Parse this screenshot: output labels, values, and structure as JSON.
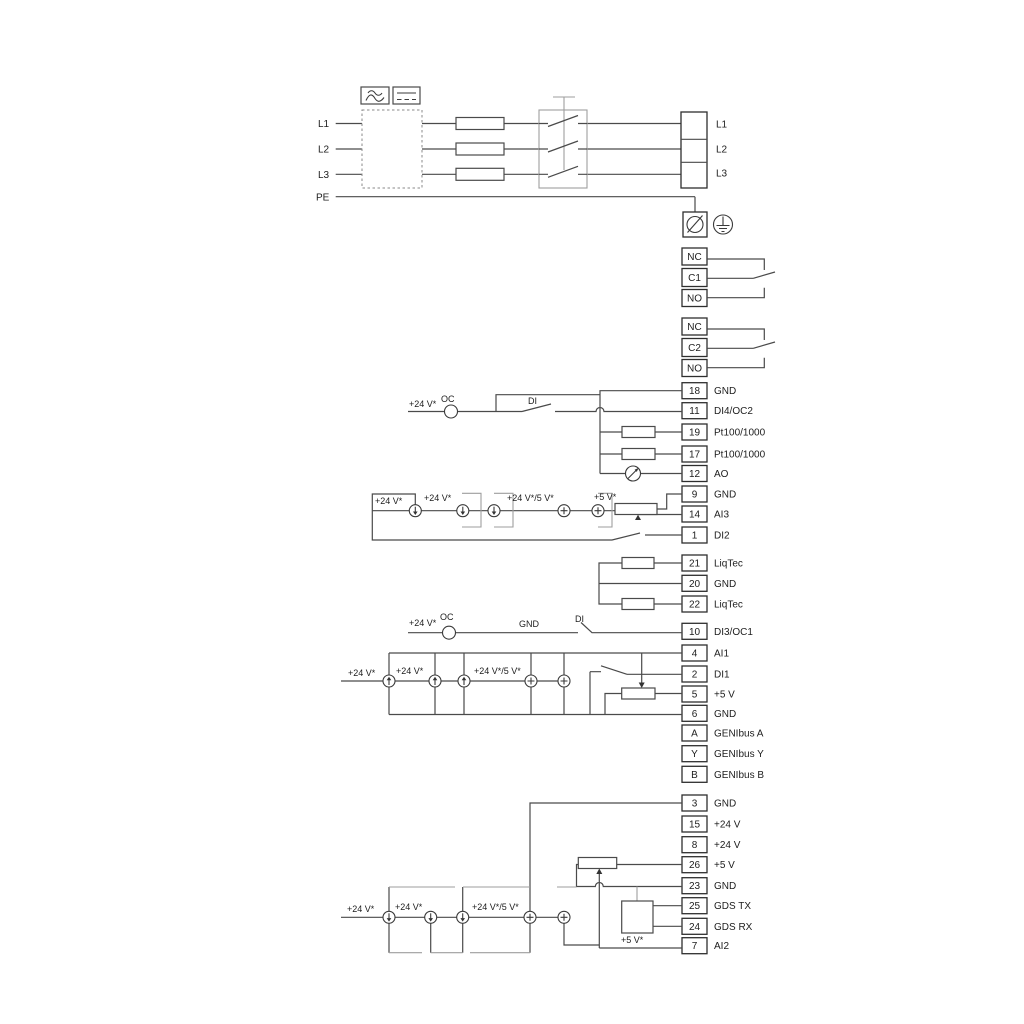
{
  "power": {
    "left": [
      "L1",
      "L2",
      "L3",
      "PE"
    ],
    "right": [
      "L1",
      "L2",
      "L3"
    ]
  },
  "relay1": {
    "rows": [
      "NC",
      "C1",
      "NO"
    ]
  },
  "relay2": {
    "rows": [
      "NC",
      "C2",
      "NO"
    ]
  },
  "io1": {
    "rows": [
      {
        "num": "18",
        "label": "GND"
      },
      {
        "num": "11",
        "label": "DI4/OC2"
      },
      {
        "num": "19",
        "label": "Pt100/1000"
      },
      {
        "num": "17",
        "label": "Pt100/1000"
      },
      {
        "num": "12",
        "label": "AO"
      },
      {
        "num": "9",
        "label": "GND"
      },
      {
        "num": "14",
        "label": "AI3"
      },
      {
        "num": "1",
        "label": "DI2"
      }
    ]
  },
  "liqtec": {
    "rows": [
      {
        "num": "21",
        "label": "LiqTec"
      },
      {
        "num": "20",
        "label": "GND"
      },
      {
        "num": "22",
        "label": "LiqTec"
      }
    ]
  },
  "io2": {
    "rows": [
      {
        "num": "10",
        "label": "DI3/OC1"
      },
      {
        "num": "4",
        "label": "AI1"
      },
      {
        "num": "2",
        "label": "DI1"
      },
      {
        "num": "5",
        "label": "+5 V"
      },
      {
        "num": "6",
        "label": "GND"
      },
      {
        "num": "A",
        "label": "GENIbus A"
      },
      {
        "num": "Y",
        "label": "GENIbus Y"
      },
      {
        "num": "B",
        "label": "GENIbus B"
      }
    ]
  },
  "io3": {
    "rows": [
      {
        "num": "3",
        "label": "GND"
      },
      {
        "num": "15",
        "label": "+24 V"
      },
      {
        "num": "8",
        "label": "+24 V"
      },
      {
        "num": "26",
        "label": "+5 V"
      },
      {
        "num": "23",
        "label": "GND"
      },
      {
        "num": "25",
        "label": "GDS TX"
      },
      {
        "num": "24",
        "label": "GDS RX"
      },
      {
        "num": "7",
        "label": "AI2"
      }
    ]
  },
  "ann": {
    "v24": "+24 V*",
    "v24_5": "+24 V*/5 V*",
    "v5": "+5 V*",
    "oc": "OC",
    "di": "DI",
    "gnd": "GND"
  },
  "colors": {
    "wire": "#4a4a4a",
    "wire_light": "#9e9e9e",
    "text": "#1d1d1d",
    "background": "#ffffff"
  }
}
